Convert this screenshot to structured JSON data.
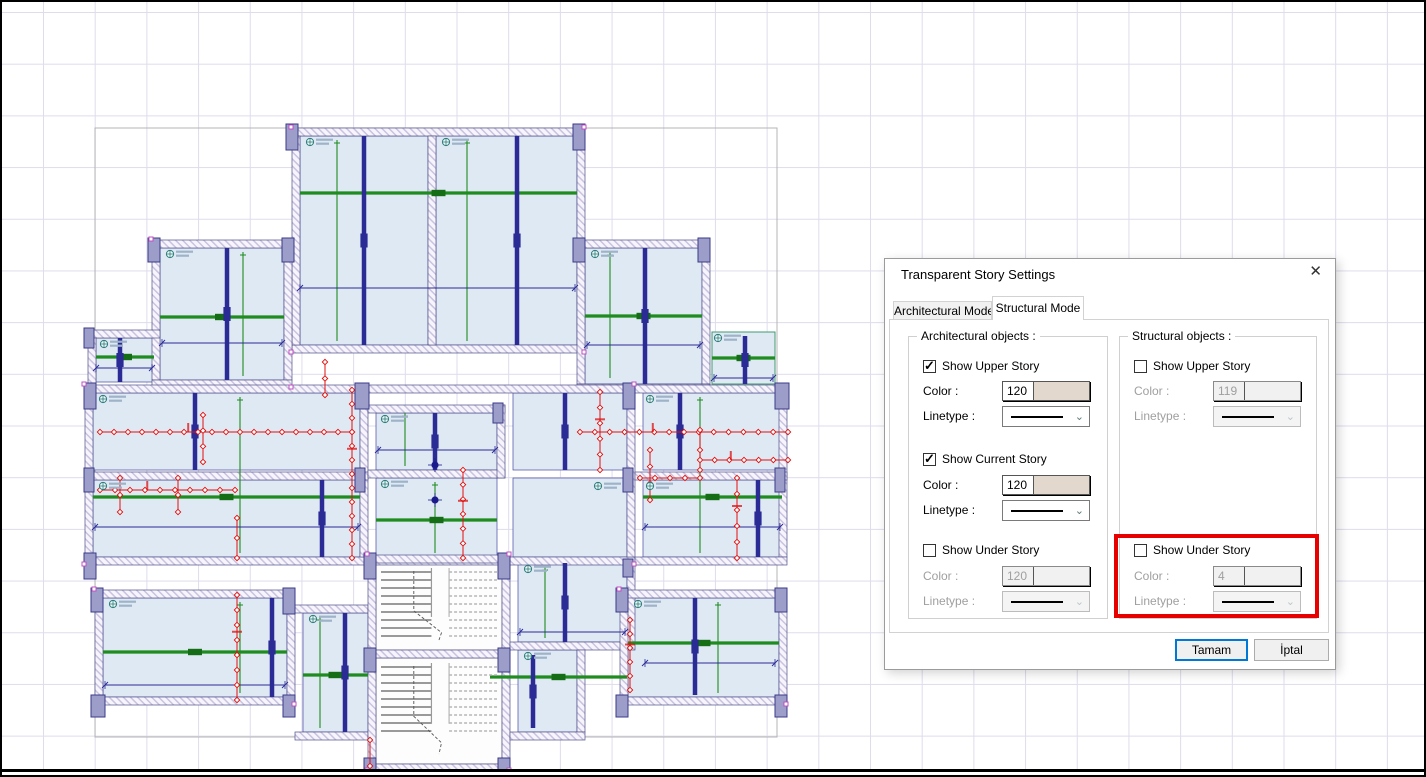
{
  "dialog": {
    "title": "Transparent Story Settings",
    "close_icon": "✕",
    "tabs": [
      {
        "label": "Architectural Mode",
        "active": false
      },
      {
        "label": "Structural Mode",
        "active": true
      }
    ],
    "arch_group": {
      "title": "Architectural objects :",
      "upper": {
        "label": "Show Upper Story",
        "checked": true,
        "disabled": false,
        "color_label": "Color :",
        "color_value": "120",
        "swatch": "#e2d8cd",
        "linetype_label": "Linetype :"
      },
      "current": {
        "label": "Show Current Story",
        "checked": true,
        "disabled": false,
        "color_label": "Color :",
        "color_value": "120",
        "swatch": "#e2d8cd",
        "linetype_label": "Linetype :"
      },
      "under": {
        "label": "Show Under Story",
        "checked": false,
        "disabled": true,
        "color_label": "Color :",
        "color_value": "120",
        "swatch": "#f1f1f1",
        "linetype_label": "Linetype :"
      }
    },
    "struct_group": {
      "title": "Structural objects :",
      "upper": {
        "label": "Show Upper Story",
        "checked": false,
        "disabled": true,
        "color_label": "Color :",
        "color_value": "119",
        "swatch": "#f1f1f1",
        "linetype_label": "Linetype :"
      },
      "under": {
        "label": "Show Under Story",
        "checked": false,
        "disabled": true,
        "color_label": "Color :",
        "color_value": "4",
        "swatch": "#f1f1f1",
        "linetype_label": "Linetype :",
        "highlighted": true
      }
    },
    "ok_label": "Tamam",
    "cancel_label": "İptal",
    "highlight_color": "#e60000",
    "primary_button_color": "#0078d7"
  },
  "canvas": {
    "grid_color": "#dfdcec",
    "background": "#ffffff"
  },
  "plan": {
    "palette": {
      "slab": "#dfe9f4",
      "slab_edge": "#4646a0",
      "wall_fill": "#f7f5fb",
      "wall_hatch": "#c9c3e0",
      "wall_edge": "#50508a",
      "column_fill": "#9d9dca",
      "column_edge": "#3a3a88",
      "beam_green": "#1e8c1e",
      "beam_green_dark": "#156e15",
      "beam_navy": "#2b2b96",
      "dim": "#2b2b96",
      "load_red": "#e01010",
      "outline": "#b4b4b4",
      "stair": "#9a9a9a",
      "stair_dash": "#b6b6b6",
      "label_teal": "#2e7d7d",
      "label_bar": "#9fb3c8",
      "vertex": "#c050c0",
      "node": "#1b1b8c",
      "stair_bg": "#fdfdfd",
      "glass_edge": "#3f9a6e"
    },
    "outline": [
      95,
      128,
      682,
      609
    ],
    "rooms": [
      [
        300,
        136,
        128,
        209
      ],
      [
        436,
        136,
        141,
        209
      ],
      [
        160,
        248,
        124,
        132
      ],
      [
        585,
        248,
        117,
        136
      ],
      [
        96,
        338,
        58,
        44
      ],
      [
        93,
        393,
        267,
        77
      ],
      [
        93,
        480,
        267,
        77
      ],
      [
        376,
        413,
        121,
        57
      ],
      [
        376,
        478,
        121,
        79
      ],
      [
        513,
        393,
        114,
        77
      ],
      [
        513,
        478,
        114,
        79
      ],
      [
        643,
        393,
        139,
        77
      ],
      [
        643,
        480,
        139,
        77
      ],
      [
        103,
        598,
        184,
        99
      ],
      [
        303,
        613,
        65,
        119
      ],
      [
        518,
        563,
        109,
        79
      ],
      [
        628,
        598,
        151,
        99
      ],
      [
        518,
        650,
        59,
        82
      ]
    ],
    "glass_rooms": [
      [
        712,
        332,
        63,
        52
      ]
    ],
    "stair_rooms": [
      [
        376,
        563,
        126,
        87
      ],
      [
        376,
        658,
        126,
        106
      ]
    ],
    "walls": [
      [
        292,
        128,
        293,
        8
      ],
      [
        292,
        345,
        293,
        8
      ],
      [
        292,
        136,
        8,
        209
      ],
      [
        577,
        136,
        8,
        209
      ],
      [
        428,
        136,
        8,
        209
      ],
      [
        152,
        240,
        140,
        8
      ],
      [
        152,
        248,
        8,
        132
      ],
      [
        284,
        248,
        8,
        132
      ],
      [
        152,
        380,
        140,
        8
      ],
      [
        577,
        240,
        133,
        8
      ],
      [
        702,
        248,
        8,
        136
      ],
      [
        577,
        248,
        8,
        136
      ],
      [
        577,
        384,
        133,
        8
      ],
      [
        88,
        330,
        72,
        8
      ],
      [
        88,
        338,
        8,
        50
      ],
      [
        85,
        385,
        550,
        8
      ],
      [
        85,
        393,
        8,
        164
      ],
      [
        85,
        557,
        550,
        8
      ],
      [
        627,
        393,
        8,
        164
      ],
      [
        360,
        393,
        8,
        164
      ],
      [
        85,
        472,
        283,
        8
      ],
      [
        368,
        405,
        137,
        8
      ],
      [
        368,
        470,
        137,
        8
      ],
      [
        497,
        405,
        8,
        73
      ],
      [
        635,
        385,
        152,
        8
      ],
      [
        779,
        393,
        8,
        164
      ],
      [
        635,
        472,
        152,
        8
      ],
      [
        635,
        557,
        152,
        8
      ],
      [
        95,
        590,
        200,
        8
      ],
      [
        95,
        598,
        8,
        100
      ],
      [
        95,
        697,
        200,
        8
      ],
      [
        287,
        598,
        8,
        100
      ],
      [
        295,
        605,
        73,
        8
      ],
      [
        295,
        732,
        73,
        8
      ],
      [
        368,
        555,
        8,
        217
      ],
      [
        502,
        555,
        8,
        217
      ],
      [
        368,
        555,
        142,
        8
      ],
      [
        368,
        650,
        142,
        8
      ],
      [
        368,
        764,
        142,
        8
      ],
      [
        510,
        642,
        125,
        8
      ],
      [
        627,
        563,
        8,
        80
      ],
      [
        620,
        590,
        167,
        8
      ],
      [
        779,
        598,
        8,
        100
      ],
      [
        620,
        697,
        167,
        8
      ],
      [
        620,
        598,
        8,
        100
      ],
      [
        577,
        650,
        8,
        82
      ],
      [
        510,
        732,
        75,
        8
      ]
    ],
    "columns": [
      [
        286,
        124,
        12,
        26
      ],
      [
        573,
        124,
        12,
        26
      ],
      [
        148,
        238,
        12,
        24
      ],
      [
        282,
        238,
        12,
        24
      ],
      [
        573,
        238,
        12,
        24
      ],
      [
        698,
        238,
        12,
        24
      ],
      [
        84,
        328,
        10,
        20
      ],
      [
        84,
        383,
        12,
        26
      ],
      [
        355,
        383,
        14,
        26
      ],
      [
        623,
        383,
        12,
        26
      ],
      [
        775,
        383,
        14,
        26
      ],
      [
        84,
        468,
        10,
        24
      ],
      [
        84,
        553,
        12,
        26
      ],
      [
        355,
        468,
        10,
        24
      ],
      [
        623,
        468,
        10,
        24
      ],
      [
        775,
        468,
        10,
        24
      ],
      [
        493,
        403,
        10,
        20
      ],
      [
        91,
        588,
        12,
        24
      ],
      [
        283,
        588,
        12,
        26
      ],
      [
        91,
        695,
        14,
        22
      ],
      [
        283,
        695,
        12,
        22
      ],
      [
        364,
        553,
        12,
        26
      ],
      [
        498,
        553,
        12,
        26
      ],
      [
        364,
        648,
        12,
        24
      ],
      [
        498,
        648,
        12,
        24
      ],
      [
        364,
        758,
        12,
        14
      ],
      [
        498,
        758,
        12,
        14
      ],
      [
        616,
        588,
        12,
        24
      ],
      [
        775,
        588,
        12,
        24
      ],
      [
        616,
        695,
        12,
        22
      ],
      [
        775,
        695,
        12,
        22
      ],
      [
        623,
        559,
        10,
        18
      ]
    ],
    "green_h": [
      [
        300,
        193,
        577
      ],
      [
        160,
        317,
        284
      ],
      [
        585,
        316,
        702
      ],
      [
        96,
        357,
        154
      ],
      [
        712,
        358,
        775
      ],
      [
        93,
        497,
        360
      ],
      [
        643,
        497,
        782
      ],
      [
        376,
        520,
        497
      ],
      [
        103,
        652,
        287
      ],
      [
        303,
        675,
        368
      ],
      [
        490,
        677,
        627
      ],
      [
        628,
        643,
        779
      ]
    ],
    "green_v": [
      [
        337,
        140,
        341
      ],
      [
        467,
        140,
        341
      ],
      [
        243,
        252,
        376
      ],
      [
        610,
        252,
        378
      ],
      [
        240,
        397,
        553
      ],
      [
        700,
        397,
        553
      ],
      [
        435,
        482,
        553
      ],
      [
        405,
        413,
        466
      ],
      [
        240,
        602,
        693
      ],
      [
        320,
        617,
        728
      ],
      [
        718,
        602,
        693
      ],
      [
        545,
        567,
        638
      ]
    ],
    "navy": [
      [
        364,
        136,
        345
      ],
      [
        517,
        136,
        345
      ],
      [
        227,
        248,
        380
      ],
      [
        645,
        248,
        384
      ],
      [
        120,
        338,
        382
      ],
      [
        745,
        336,
        384
      ],
      [
        195,
        393,
        470
      ],
      [
        322,
        480,
        557
      ],
      [
        435,
        413,
        470
      ],
      [
        565,
        393,
        470
      ],
      [
        680,
        393,
        470
      ],
      [
        758,
        480,
        557
      ],
      [
        272,
        598,
        697
      ],
      [
        345,
        613,
        732
      ],
      [
        565,
        563,
        642
      ],
      [
        695,
        598,
        695
      ],
      [
        533,
        655,
        728
      ]
    ],
    "dims": [
      [
        300,
        288,
        575,
        288
      ],
      [
        162,
        343,
        282,
        343
      ],
      [
        587,
        345,
        700,
        345
      ],
      [
        96,
        368,
        152,
        368
      ],
      [
        714,
        378,
        773,
        378
      ],
      [
        95,
        527,
        358,
        527
      ],
      [
        645,
        527,
        780,
        527
      ],
      [
        378,
        450,
        495,
        450
      ],
      [
        105,
        685,
        285,
        685
      ],
      [
        520,
        632,
        625,
        632
      ],
      [
        645,
        663,
        775,
        663
      ]
    ],
    "reds": [
      [
        100,
        432,
        352,
        432
      ],
      [
        352,
        390,
        352,
        558
      ],
      [
        203,
        415,
        203,
        462
      ],
      [
        100,
        490,
        235,
        490
      ],
      [
        120,
        478,
        120,
        512
      ],
      [
        178,
        478,
        178,
        512
      ],
      [
        237,
        518,
        237,
        558
      ],
      [
        580,
        432,
        788,
        432
      ],
      [
        600,
        392,
        600,
        470
      ],
      [
        650,
        450,
        650,
        500
      ],
      [
        640,
        478,
        700,
        478
      ],
      [
        700,
        430,
        700,
        470
      ],
      [
        700,
        460,
        788,
        460
      ],
      [
        737,
        478,
        737,
        558
      ],
      [
        463,
        470,
        463,
        558
      ],
      [
        325,
        362,
        325,
        395
      ],
      [
        237,
        595,
        237,
        700
      ],
      [
        630,
        620,
        630,
        690
      ],
      [
        370,
        740,
        370,
        766
      ]
    ],
    "labels": [
      [
        310,
        142
      ],
      [
        446,
        142
      ],
      [
        170,
        254
      ],
      [
        595,
        254
      ],
      [
        104,
        344
      ],
      [
        718,
        338
      ],
      [
        103,
        399
      ],
      [
        103,
        486
      ],
      [
        385,
        419
      ],
      [
        650,
        399
      ],
      [
        650,
        486
      ],
      [
        385,
        484
      ],
      [
        113,
        604
      ],
      [
        313,
        619
      ],
      [
        528,
        569
      ],
      [
        638,
        604
      ],
      [
        528,
        656
      ],
      [
        598,
        486
      ]
    ],
    "vertices": [
      [
        291,
        127
      ],
      [
        584,
        127
      ],
      [
        291,
        352
      ],
      [
        584,
        352
      ],
      [
        151,
        239
      ],
      [
        291,
        387
      ],
      [
        84,
        384
      ],
      [
        634,
        384
      ],
      [
        84,
        564
      ],
      [
        634,
        564
      ],
      [
        367,
        554
      ],
      [
        509,
        554
      ],
      [
        367,
        770
      ],
      [
        509,
        770
      ],
      [
        94,
        589
      ],
      [
        294,
        704
      ],
      [
        619,
        589
      ],
      [
        786,
        704
      ]
    ],
    "nodes": [
      [
        435,
        465
      ],
      [
        435,
        500
      ]
    ]
  }
}
